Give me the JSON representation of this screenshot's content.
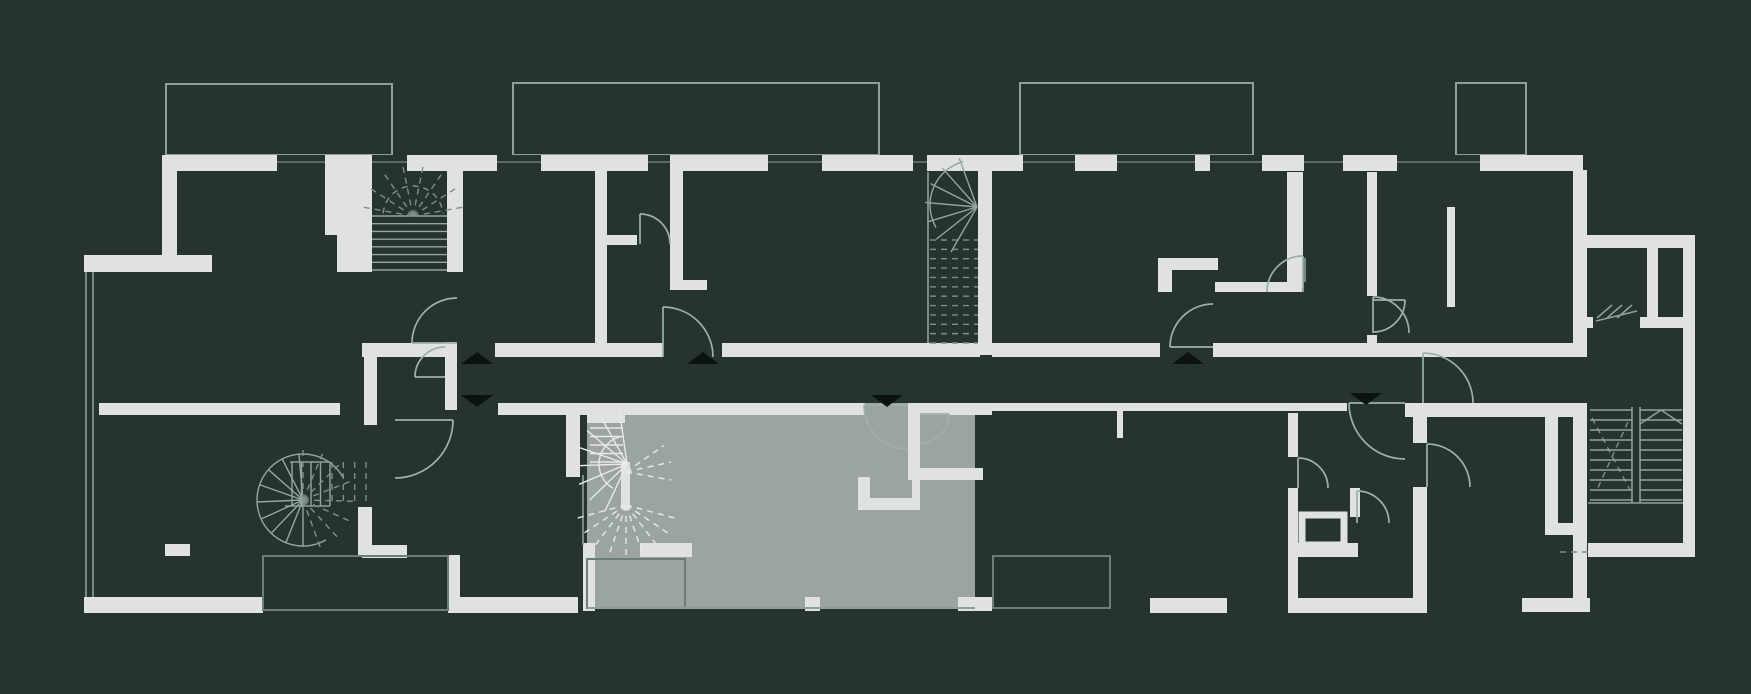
{
  "canvas": {
    "width": 1751,
    "height": 694
  },
  "colors": {
    "background": "#273330",
    "wall": "#dfe2e0",
    "thin": "#8da09a",
    "thin_dim": "#6c7e78",
    "door": "#9db1ab",
    "stair": "#93a6a0",
    "stair_white": "#e6eae8",
    "dash": "#7d908a",
    "highlight_fill": "#9ba4a0",
    "marker_black": "#0c1210"
  },
  "plan": {
    "balconies": [
      {
        "x": 166,
        "y": 84,
        "w": 226,
        "h": 71
      },
      {
        "x": 513,
        "y": 83,
        "w": 366,
        "h": 72
      },
      {
        "x": 1020,
        "y": 83,
        "w": 233,
        "h": 72
      },
      {
        "x": 1456,
        "y": 83,
        "w": 70,
        "h": 72
      }
    ],
    "top_wall": {
      "x": 162,
      "y": 155,
      "w": 1421,
      "h": 16
    },
    "window_gaps": [
      [
        277,
        330
      ],
      [
        372,
        407
      ],
      [
        497,
        541
      ],
      [
        648,
        670
      ],
      [
        768,
        822
      ],
      [
        913,
        927
      ],
      [
        1023,
        1075
      ],
      [
        1117,
        1195
      ],
      [
        1210,
        1262
      ],
      [
        1304,
        1343
      ],
      [
        1397,
        1480
      ]
    ],
    "highlight": {
      "main": {
        "x": 587,
        "y": 415,
        "w": 388,
        "h": 193
      },
      "extra": [
        {
          "x": 865,
          "y": 403,
          "w": 43,
          "h": 12
        }
      ],
      "bottom_edge": [
        587,
        608,
        975,
        608
      ]
    },
    "walls": [
      [
        162,
        171,
        15,
        84
      ],
      [
        84,
        255,
        128,
        17
      ],
      [
        325,
        155,
        13,
        80
      ],
      [
        337,
        171,
        35,
        101
      ],
      [
        447,
        171,
        16,
        101
      ],
      [
        595,
        162,
        12,
        181
      ],
      [
        603,
        235,
        34,
        10
      ],
      [
        670,
        155,
        13,
        131
      ],
      [
        670,
        280,
        37,
        10
      ],
      [
        978,
        171,
        14,
        184
      ],
      [
        1287,
        172,
        16,
        116
      ],
      [
        1367,
        172,
        10,
        124
      ],
      [
        1367,
        335,
        10,
        20
      ],
      [
        1447,
        207,
        8,
        100
      ],
      [
        1158,
        258,
        60,
        12
      ],
      [
        1158,
        258,
        14,
        34
      ],
      [
        1215,
        282,
        87,
        10
      ],
      [
        1573,
        170,
        14,
        187
      ],
      [
        1573,
        403,
        14,
        209
      ],
      [
        362,
        343,
        95,
        14
      ],
      [
        364,
        343,
        13,
        82
      ],
      [
        495,
        343,
        168,
        14
      ],
      [
        722,
        343,
        258,
        14
      ],
      [
        992,
        343,
        168,
        14
      ],
      [
        1213,
        343,
        360,
        14
      ],
      [
        99,
        403,
        241,
        12
      ],
      [
        445,
        342,
        12,
        68
      ],
      [
        498,
        403,
        367,
        12
      ],
      [
        908,
        403,
        84,
        12
      ],
      [
        992,
        403,
        355,
        8
      ],
      [
        1405,
        403,
        182,
        14
      ],
      [
        566,
        403,
        14,
        74
      ],
      [
        583,
        543,
        12,
        68
      ],
      [
        587,
        403,
        38,
        20
      ],
      [
        908,
        415,
        12,
        65
      ],
      [
        920,
        468,
        63,
        12
      ],
      [
        858,
        477,
        12,
        33
      ],
      [
        858,
        498,
        59,
        12
      ],
      [
        912,
        477,
        8,
        33
      ],
      [
        640,
        543,
        52,
        14
      ],
      [
        805,
        597,
        15,
        14
      ],
      [
        958,
        597,
        34,
        14
      ],
      [
        621,
        462,
        9,
        46
      ],
      [
        358,
        507,
        14,
        50
      ],
      [
        362,
        545,
        45,
        13
      ],
      [
        165,
        544,
        25,
        12
      ],
      [
        84,
        597,
        179,
        16
      ],
      [
        448,
        597,
        130,
        16
      ],
      [
        448,
        555,
        12,
        43
      ],
      [
        1117,
        410,
        6,
        28
      ],
      [
        1288,
        413,
        10,
        44
      ],
      [
        1288,
        488,
        10,
        110
      ],
      [
        1288,
        543,
        70,
        14
      ],
      [
        1350,
        488,
        10,
        29
      ],
      [
        1413,
        417,
        14,
        26
      ],
      [
        1413,
        487,
        14,
        126
      ],
      [
        1150,
        598,
        77,
        15
      ],
      [
        1288,
        598,
        137,
        15
      ],
      [
        1545,
        413,
        13,
        122
      ],
      [
        1545,
        523,
        28,
        12
      ],
      [
        1522,
        598,
        68,
        14
      ],
      [
        1583,
        235,
        110,
        13
      ],
      [
        1683,
        235,
        12,
        322
      ],
      [
        1588,
        543,
        107,
        14
      ],
      [
        1647,
        248,
        11,
        80
      ],
      [
        1583,
        317,
        10,
        11
      ],
      [
        1640,
        317,
        43,
        11
      ]
    ],
    "thin_rects": [
      {
        "x": 263,
        "y": 556,
        "w": 185,
        "h": 54
      },
      {
        "x": 993,
        "y": 556,
        "w": 117,
        "h": 52
      },
      {
        "x": 587,
        "y": 559,
        "w": 98,
        "h": 49
      }
    ],
    "closet": {
      "x": 1302,
      "y": 515,
      "w": 42,
      "h": 30
    },
    "thin_lines": [
      [
        86,
        272,
        86,
        597
      ],
      [
        93,
        272,
        93,
        597
      ],
      [
        583,
        475,
        583,
        545
      ],
      [
        1305,
        258,
        1305,
        282
      ],
      [
        928,
        172,
        928,
        343
      ],
      [
        1596,
        321,
        1637,
        311
      ],
      [
        1632,
        407,
        1632,
        503
      ],
      [
        1640,
        407,
        1640,
        503
      ],
      [
        1640,
        424,
        1661,
        410
      ],
      [
        1661,
        410,
        1682,
        424
      ],
      [
        1588,
        503,
        1683,
        503
      ],
      [
        290,
        462,
        330,
        462
      ],
      [
        285,
        506,
        330,
        506
      ],
      [
        1597,
        318,
        1612,
        305
      ],
      [
        1607,
        318,
        1622,
        305
      ],
      [
        1617,
        318,
        1632,
        305
      ]
    ],
    "dashed_lines": [
      [
        1560,
        552,
        1588,
        552
      ],
      [
        1592,
        418,
        1630,
        490
      ],
      [
        1628,
        422,
        1596,
        492
      ]
    ],
    "doors": [
      {
        "path": "M412,343 A45,45 0 0 1 457,298",
        "leaf": [
          457,
          343,
          412,
          343
        ]
      },
      {
        "path": "M415,377 A30,30 0 0 1 445,347",
        "leaf": [
          445,
          377,
          415,
          377
        ]
      },
      {
        "path": "M453,420 A58,58 0 0 1 395,478",
        "leaf": [
          395,
          420,
          453,
          420
        ]
      },
      {
        "path": "M640,214 A30,30 0 0 1 670,244",
        "leaf": [
          640,
          244,
          640,
          214
        ]
      },
      {
        "path": "M663,307 A50,50 0 0 1 713,357",
        "leaf": [
          663,
          357,
          663,
          307
        ]
      },
      {
        "path": "M864,405 A44,44 0 0 0 908,449",
        "leaf": [
          908,
          405,
          864,
          405
        ]
      },
      {
        "path": "M949,414 A29,29 0 0 1 920,443",
        "leaf": [
          920,
          414,
          949,
          414
        ]
      },
      {
        "path": "M1170,347 A43,43 0 0 1 1213,304",
        "leaf": [
          1213,
          347,
          1170,
          347
        ]
      },
      {
        "path": "M1373,297 A36,36 0 0 1 1409,333",
        "leaf": [
          1373,
          333,
          1373,
          297
        ]
      },
      {
        "path": "M1405,300 A32,32 0 0 1 1373,332",
        "leaf": [
          1373,
          300,
          1405,
          300
        ]
      },
      {
        "path": "M1349,403 A56,56 0 0 0 1405,459",
        "leaf": [
          1405,
          403,
          1349,
          403
        ]
      },
      {
        "path": "M1423,353 A50,50 0 0 1 1473,403",
        "leaf": [
          1423,
          403,
          1423,
          353
        ]
      },
      {
        "path": "M1298,458 A30,30 0 0 1 1328,488",
        "leaf": [
          1298,
          488,
          1298,
          458
        ]
      },
      {
        "path": "M1357,491 A32,32 0 0 1 1389,523",
        "leaf": [
          1357,
          523,
          1357,
          491
        ]
      },
      {
        "path": "M1427,444 A43,43 0 0 1 1470,487",
        "leaf": [
          1427,
          487,
          1427,
          444
        ]
      },
      {
        "path": "M1303,256 A36,36 0 0 0 1267,292",
        "leaf": [
          1303,
          292,
          1303,
          256
        ]
      }
    ],
    "direction_markers": [
      {
        "x": 477,
        "y": 358,
        "dir": "up"
      },
      {
        "x": 703,
        "y": 358,
        "dir": "up"
      },
      {
        "x": 1188,
        "y": 358,
        "dir": "up"
      },
      {
        "x": 477,
        "y": 401,
        "dir": "down"
      },
      {
        "x": 887,
        "y": 401,
        "dir": "down"
      },
      {
        "x": 1366,
        "y": 399,
        "dir": "down"
      }
    ],
    "stairs": [
      {
        "id": "stair-top-left",
        "parts": [
          {
            "kind": "treads",
            "x0": 372,
            "x1": 447,
            "y0": 216,
            "y1": 270,
            "n": 8,
            "dashed": false,
            "color": "stair"
          },
          {
            "kind": "fan",
            "cx": 413,
            "cy": 216,
            "r": 52,
            "a0": 190,
            "a1": 350,
            "n": 8,
            "dashed": true,
            "color": "dash"
          },
          {
            "kind": "arc",
            "cx": 413,
            "cy": 216,
            "r": 30,
            "a0": 185,
            "a1": 355,
            "dashed": true,
            "color": "dash"
          }
        ]
      },
      {
        "id": "stair-top-center",
        "parts": [
          {
            "kind": "treads",
            "x0": 930,
            "x1": 978,
            "y0": 240,
            "y1": 343,
            "n": 12,
            "dashed": true,
            "color": "dash"
          },
          {
            "kind": "fan",
            "cx": 977,
            "cy": 207,
            "r": 52,
            "a0": 120,
            "a1": 250,
            "n": 7,
            "dashed": false,
            "color": "stair"
          },
          {
            "kind": "arc",
            "cx": 975,
            "cy": 205,
            "r": 45,
            "a0": 150,
            "a1": 255,
            "dashed": false,
            "color": "stair"
          }
        ]
      },
      {
        "id": "stair-spiral-left",
        "parts": [
          {
            "kind": "arc",
            "cx": 303,
            "cy": 500,
            "r": 46,
            "a0": 60,
            "a1": 330,
            "dashed": false,
            "color": "stair"
          },
          {
            "kind": "fan",
            "cx": 303,
            "cy": 500,
            "r": 46,
            "a0": 90,
            "a1": 265,
            "n": 9,
            "dashed": false,
            "color": "stair"
          },
          {
            "kind": "vtreads",
            "x0": 292,
            "x1": 330,
            "y0": 462,
            "y1": 506,
            "n": 5,
            "dashed": false,
            "color": "stair"
          },
          {
            "kind": "fan",
            "cx": 303,
            "cy": 500,
            "r": 52,
            "a0": 270,
            "a1": 430,
            "n": 8,
            "dashed": true,
            "color": "dash"
          },
          {
            "kind": "vtreads",
            "x0": 332,
            "x1": 366,
            "y0": 462,
            "y1": 506,
            "n": 4,
            "dashed": true,
            "color": "dash"
          }
        ]
      },
      {
        "id": "stair-unit",
        "parts": [
          {
            "kind": "treads",
            "x0": 590,
            "x1": 623,
            "y0": 428,
            "y1": 462,
            "n": 5,
            "dashed": false,
            "color": "stair_white"
          },
          {
            "kind": "fan",
            "cx": 627,
            "cy": 464,
            "r": 52,
            "a0": 115,
            "a1": 262,
            "n": 8,
            "dashed": false,
            "color": "stair_white"
          },
          {
            "kind": "arc",
            "cx": 627,
            "cy": 464,
            "r": 28,
            "a0": 120,
            "a1": 258,
            "dashed": false,
            "color": "stair_white"
          },
          {
            "kind": "fan",
            "cx": 626,
            "cy": 505,
            "r": 50,
            "a0": 15,
            "a1": 165,
            "n": 9,
            "dashed": true,
            "color": "stair_white"
          },
          {
            "kind": "fan",
            "cx": 626,
            "cy": 472,
            "r": 46,
            "a0": -35,
            "a1": 10,
            "n": 3,
            "dashed": true,
            "color": "stair_white"
          }
        ]
      },
      {
        "id": "stair-wing",
        "parts": [
          {
            "kind": "treads",
            "x0": 1590,
            "x1": 1632,
            "y0": 410,
            "y1": 500,
            "n": 10,
            "dashed": false,
            "color": "stair"
          },
          {
            "kind": "treads",
            "x0": 1640,
            "x1": 1682,
            "y0": 410,
            "y1": 500,
            "n": 10,
            "dashed": false,
            "color": "stair"
          }
        ]
      }
    ]
  }
}
